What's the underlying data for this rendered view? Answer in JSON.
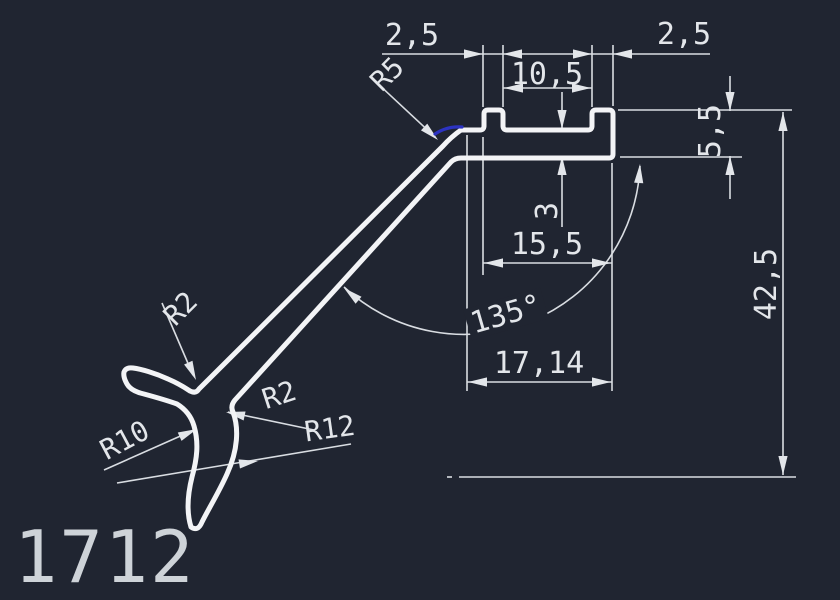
{
  "drawing": {
    "part_label": "1712",
    "dimensions": {
      "tab_left": "2,5",
      "slot_width": "10,5",
      "tab_right": "2,5",
      "base_thickness": "3",
      "top_width": "15,5",
      "angle": "135°",
      "overall_width": "17,14",
      "top_height": "5,5",
      "overall_height": "42,5"
    },
    "radii": {
      "fillet_top": "R5",
      "fillet_notch": "R2",
      "fillet_claw": "R2",
      "radius_inner": "R10",
      "radius_outer": "R12"
    },
    "colors": {
      "background": "#202531",
      "lines": "#d9dde2",
      "profile": "#f3f4f6",
      "text": "#e3e6ea",
      "highlight_selection": "#2c33c2"
    }
  }
}
